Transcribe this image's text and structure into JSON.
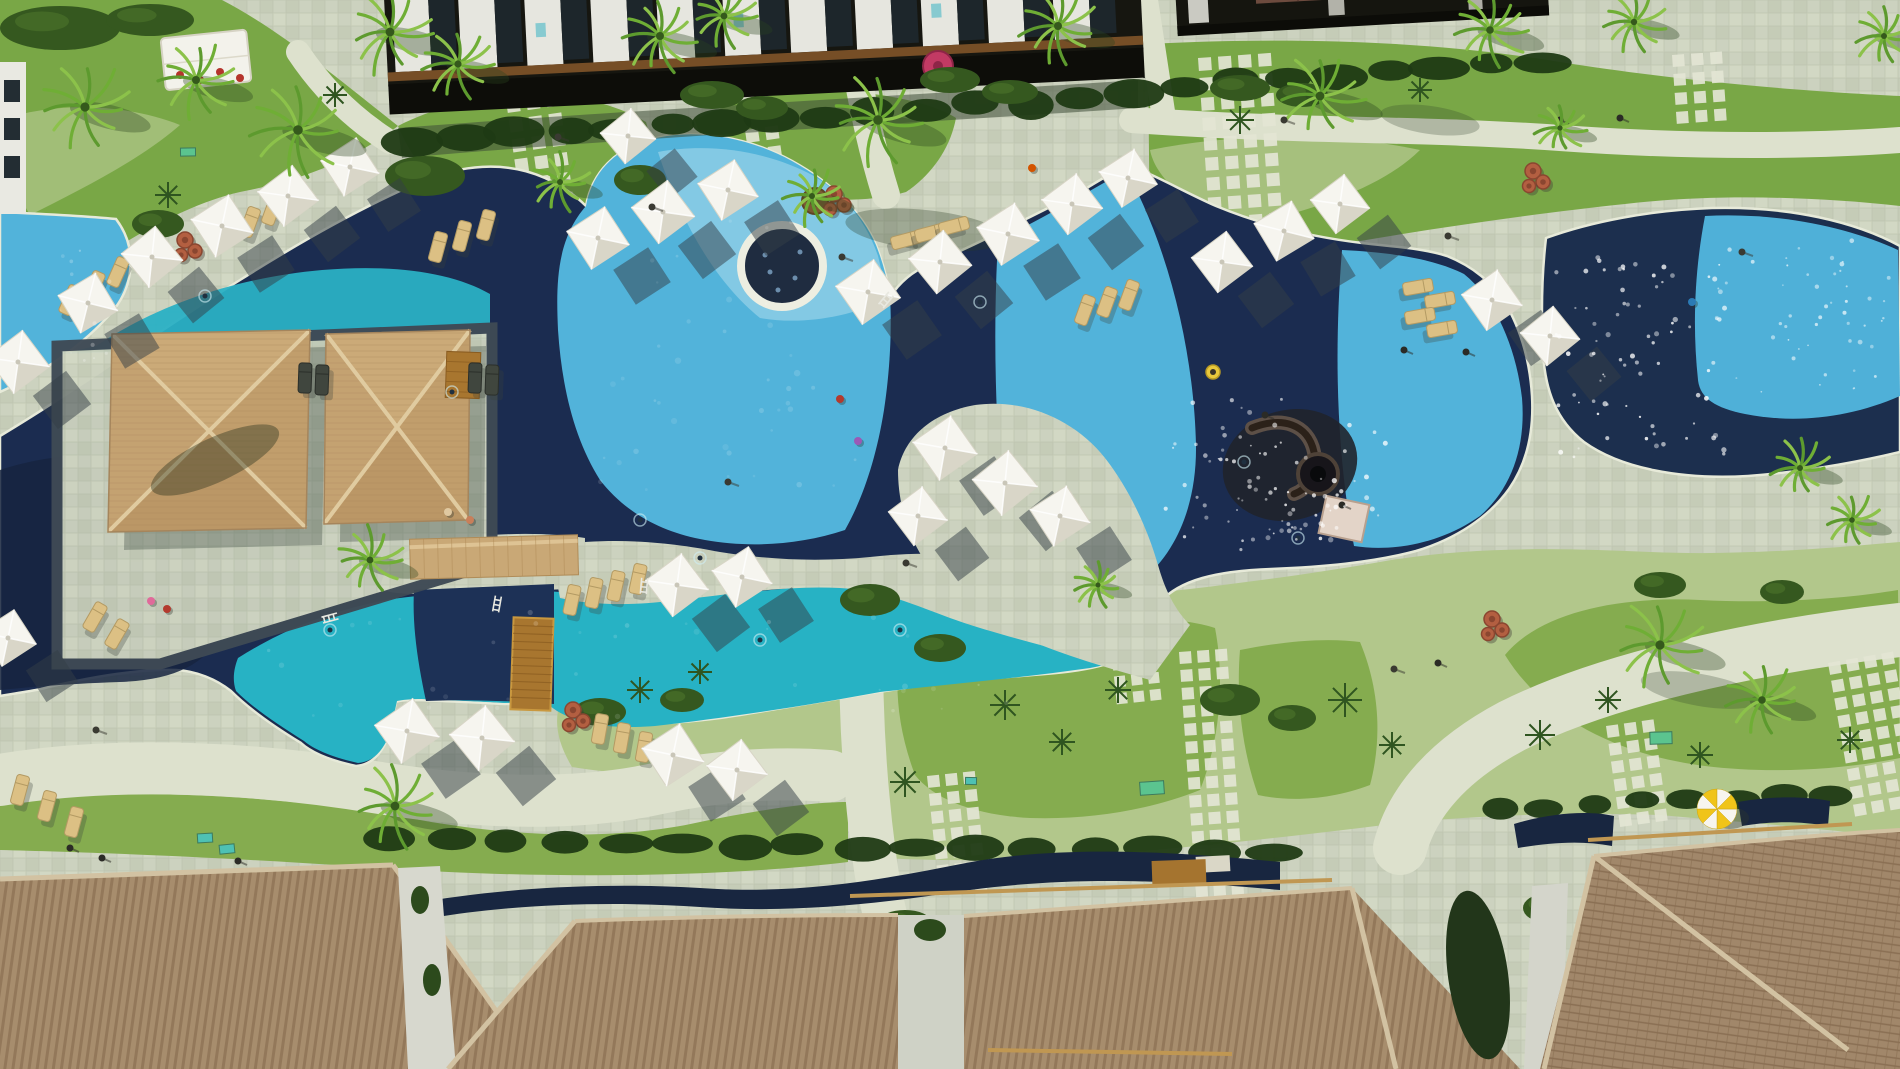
{
  "meta": {
    "description": "Aerial drone view of a tropical resort: lagoon swimming pools with alternating turquoise and navy sections, round spa, thatched cabanas, white sun umbrellas, gardens and tiled villa roofs",
    "view": "top-down aerial photo",
    "width": 1900,
    "height": 1069
  },
  "palette": {
    "deck": "#ccd2bf",
    "deck_alt": "#c2c9b3",
    "deck_bright": "#dde1cd",
    "pool_dark": "#1b2c50",
    "pool_darker": "#16253f",
    "pool_light": "#52b3da",
    "pool_pale": "#83c9e4",
    "pool_teal": "#27b2c4",
    "pool_band_dark": "#1d3156",
    "grass": "#79a746",
    "grass_bright": "#85ac4f",
    "groundcover": "#b2c78b",
    "hedge": "#1f3a14",
    "bush": "#35581f",
    "cabana_tan": "#c7a472",
    "ridge": "#e0cba0",
    "roof_brown": "#a78d6d",
    "roof_stripe": "#8f7456",
    "roof_cap": "#d2c2a2",
    "wood": "#a8762f",
    "terracotta": "#b35f41",
    "umbrella": "#f6f5ef",
    "umbrella_shade": "#d9d6c8",
    "shadow": "#333d46",
    "palm": "#6fae35",
    "sparkle": "#ffffff",
    "building_dark": "#161610",
    "building_wall": "#e6e6df",
    "balcony_wood": "#7b5128"
  },
  "objects": {
    "umbrellas": [
      [
        18,
        362,
        64,
        8
      ],
      [
        88,
        303,
        62,
        14
      ],
      [
        152,
        257,
        62,
        6
      ],
      [
        222,
        226,
        64,
        12
      ],
      [
        288,
        196,
        62,
        8
      ],
      [
        350,
        167,
        60,
        12
      ],
      [
        598,
        238,
        64,
        12
      ],
      [
        663,
        212,
        64,
        8
      ],
      [
        728,
        190,
        62,
        12
      ],
      [
        628,
        136,
        56,
        6
      ],
      [
        868,
        292,
        66,
        10
      ],
      [
        940,
        262,
        64,
        6
      ],
      [
        1008,
        234,
        64,
        12
      ],
      [
        1072,
        204,
        62,
        8
      ],
      [
        1128,
        178,
        60,
        12
      ],
      [
        1222,
        262,
        62,
        8
      ],
      [
        1284,
        231,
        62,
        14
      ],
      [
        1340,
        204,
        60,
        8
      ],
      [
        1492,
        300,
        62,
        10
      ],
      [
        1550,
        336,
        60,
        6
      ],
      [
        945,
        448,
        66,
        10
      ],
      [
        1005,
        483,
        66,
        6
      ],
      [
        1060,
        516,
        62,
        12
      ],
      [
        918,
        516,
        60,
        8
      ],
      [
        677,
        585,
        64,
        8
      ],
      [
        742,
        577,
        62,
        12
      ],
      [
        407,
        731,
        66,
        10
      ],
      [
        482,
        738,
        66,
        6
      ],
      [
        673,
        755,
        64,
        12
      ],
      [
        737,
        770,
        62,
        8
      ],
      [
        8,
        638,
        58,
        12
      ]
    ],
    "umbrella_shadow_offset": {
      "dx": 44,
      "dy": 38
    },
    "loungers": [
      [
        70,
        300,
        24,
        0
      ],
      [
        94,
        286,
        24,
        0
      ],
      [
        118,
        272,
        24,
        0
      ],
      [
        250,
        222,
        20,
        0
      ],
      [
        272,
        210,
        20,
        0
      ],
      [
        438,
        247,
        15,
        0
      ],
      [
        462,
        236,
        15,
        0
      ],
      [
        486,
        225,
        15,
        0
      ],
      [
        906,
        240,
        75,
        0
      ],
      [
        930,
        233,
        75,
        0
      ],
      [
        954,
        226,
        75,
        0
      ],
      [
        1085,
        310,
        20,
        0
      ],
      [
        1107,
        302,
        20,
        0
      ],
      [
        1129,
        295,
        20,
        0
      ],
      [
        1418,
        287,
        80,
        0
      ],
      [
        1440,
        300,
        80,
        0
      ],
      [
        1420,
        316,
        80,
        0
      ],
      [
        1442,
        329,
        80,
        0
      ],
      [
        95,
        617,
        30,
        0
      ],
      [
        117,
        634,
        30,
        0
      ],
      [
        20,
        790,
        15,
        0
      ],
      [
        47,
        806,
        15,
        0
      ],
      [
        74,
        822,
        15,
        0
      ],
      [
        600,
        729,
        10,
        0
      ],
      [
        622,
        738,
        10,
        0
      ],
      [
        644,
        747,
        10,
        0
      ],
      [
        572,
        600,
        12,
        0
      ],
      [
        594,
        593,
        12,
        0
      ],
      [
        616,
        586,
        12,
        0
      ],
      [
        638,
        579,
        12,
        0
      ],
      [
        305,
        378,
        2,
        1
      ],
      [
        322,
        380,
        2,
        1
      ],
      [
        475,
        378,
        2,
        1
      ],
      [
        492,
        380,
        2,
        1
      ]
    ],
    "palms": [
      [
        85,
        107,
        46
      ],
      [
        196,
        80,
        40
      ],
      [
        298,
        130,
        48
      ],
      [
        390,
        32,
        44
      ],
      [
        458,
        64,
        36
      ],
      [
        560,
        182,
        30
      ],
      [
        660,
        36,
        40
      ],
      [
        724,
        16,
        34
      ],
      [
        812,
        196,
        30
      ],
      [
        878,
        120,
        48
      ],
      [
        1058,
        26,
        40
      ],
      [
        1320,
        96,
        44
      ],
      [
        1490,
        30,
        38
      ],
      [
        1634,
        22,
        32
      ],
      [
        1884,
        36,
        30
      ],
      [
        370,
        560,
        34
      ],
      [
        395,
        806,
        44
      ],
      [
        1660,
        645,
        46
      ],
      [
        1762,
        700,
        38
      ],
      [
        1800,
        468,
        30
      ],
      [
        1852,
        520,
        28
      ],
      [
        1098,
        585,
        24
      ],
      [
        1560,
        128,
        26
      ]
    ],
    "yuccas": [
      [
        1005,
        705,
        15
      ],
      [
        1062,
        742,
        13
      ],
      [
        1118,
        690,
        13
      ],
      [
        1345,
        700,
        17
      ],
      [
        1392,
        745,
        13
      ],
      [
        1540,
        735,
        15
      ],
      [
        1608,
        700,
        13
      ],
      [
        905,
        782,
        15
      ],
      [
        1700,
        755,
        13
      ],
      [
        1850,
        740,
        13
      ],
      [
        640,
        690,
        13
      ],
      [
        700,
        672,
        12
      ],
      [
        1240,
        120,
        14
      ],
      [
        1420,
        90,
        12
      ],
      [
        168,
        195,
        13
      ],
      [
        335,
        95,
        12
      ]
    ],
    "bushes": [
      [
        425,
        176,
        40,
        20
      ],
      [
        158,
        224,
        26,
        14
      ],
      [
        640,
        180,
        26,
        15
      ],
      [
        712,
        95,
        32,
        14
      ],
      [
        762,
        108,
        26,
        12
      ],
      [
        950,
        80,
        30,
        13
      ],
      [
        1010,
        92,
        28,
        12
      ],
      [
        1240,
        88,
        30,
        13
      ],
      [
        1302,
        95,
        26,
        12
      ],
      [
        870,
        600,
        30,
        16
      ],
      [
        940,
        648,
        26,
        14
      ],
      [
        1230,
        700,
        30,
        16
      ],
      [
        1292,
        718,
        24,
        13
      ],
      [
        600,
        712,
        26,
        14
      ],
      [
        682,
        700,
        22,
        12
      ],
      [
        1660,
        585,
        26,
        13
      ],
      [
        1782,
        592,
        22,
        12
      ],
      [
        905,
        922,
        26,
        12
      ],
      [
        1545,
        908,
        22,
        14
      ],
      [
        60,
        28,
        60,
        22
      ],
      [
        150,
        20,
        44,
        16
      ]
    ],
    "hedgerows": [
      [
        415,
        140,
        1130,
        96,
        15,
        26,
        13
      ],
      [
        1185,
        86,
        1540,
        60,
        8,
        26,
        12
      ],
      [
        390,
        840,
        1270,
        852,
        16,
        26,
        11
      ],
      [
        1500,
        808,
        1830,
        795,
        8,
        20,
        10
      ]
    ],
    "stepping_grids": [
      [
        506,
        100,
        3,
        7,
        13,
        7,
        -8
      ],
      [
        745,
        130,
        2,
        5,
        13,
        7,
        -8
      ],
      [
        1198,
        58,
        4,
        9,
        13,
        7,
        -4
      ],
      [
        100,
        430,
        3,
        7,
        12,
        7,
        18
      ],
      [
        1672,
        55,
        3,
        4,
        12,
        7,
        -4
      ],
      [
        927,
        776,
        3,
        7,
        12,
        6,
        -6
      ],
      [
        1179,
        652,
        3,
        14,
        12,
        6,
        -4
      ],
      [
        1606,
        726,
        3,
        6,
        12,
        6,
        -8
      ],
      [
        1828,
        663,
        4,
        9,
        12,
        6,
        -10
      ],
      [
        975,
        542,
        3,
        8,
        11,
        6,
        -4
      ],
      [
        1105,
        592,
        3,
        7,
        11,
        6,
        -6
      ]
    ],
    "jar_clusters": [
      [
        185,
        249
      ],
      [
        834,
        203
      ],
      [
        573,
        719
      ],
      [
        1533,
        180
      ],
      [
        1492,
        628
      ]
    ],
    "sparkle_regions": [
      [
        1555,
        245,
        170,
        215,
        80,
        1.8,
        0.85
      ],
      [
        1705,
        230,
        185,
        165,
        50,
        1.6,
        0.7
      ],
      [
        1160,
        390,
        240,
        150,
        60,
        1.7,
        0.75
      ],
      [
        1240,
        480,
        130,
        70,
        30,
        1.8,
        0.8
      ],
      [
        590,
        210,
        270,
        280,
        40,
        2.2,
        0.16
      ],
      [
        260,
        610,
        760,
        110,
        35,
        2.0,
        0.18
      ],
      [
        55,
        245,
        55,
        120,
        12,
        1.5,
        0.3
      ]
    ],
    "mats": [
      [
        205,
        838,
        15,
        9,
        "#4ec1b4"
      ],
      [
        227,
        849,
        15,
        9,
        "#4ec1b4"
      ],
      [
        971,
        781,
        11,
        7,
        "#4ec1b4"
      ],
      [
        1152,
        788,
        24,
        13,
        "#5bc48f"
      ],
      [
        1661,
        738,
        22,
        12,
        "#5bc48f"
      ],
      [
        382,
        540,
        18,
        9,
        "#5bc48f"
      ],
      [
        188,
        152,
        15,
        8,
        "#5bc48f"
      ]
    ],
    "lamps": [
      [
        558,
        137
      ],
      [
        652,
        207
      ],
      [
        842,
        257
      ],
      [
        906,
        563
      ],
      [
        1394,
        669
      ],
      [
        1448,
        236
      ],
      [
        1284,
        120
      ],
      [
        96,
        730
      ],
      [
        1742,
        252
      ],
      [
        728,
        482
      ]
    ],
    "people": [
      [
        840,
        399,
        "#b33a2e"
      ],
      [
        858,
        441,
        "#9b59b6"
      ],
      [
        151,
        601,
        "#e06a9a"
      ],
      [
        167,
        609,
        "#b33a2e"
      ],
      [
        1032,
        168,
        "#d35400"
      ],
      [
        1692,
        302,
        "#2b7bb5"
      ],
      [
        448,
        512,
        "#e0c8a0"
      ],
      [
        470,
        520,
        "#c87f5a"
      ]
    ],
    "dark_figures": [
      [
        70,
        848
      ],
      [
        102,
        858
      ],
      [
        238,
        861
      ],
      [
        1438,
        663
      ],
      [
        1560,
        120
      ],
      [
        1620,
        118
      ],
      [
        1404,
        350
      ],
      [
        1466,
        352
      ],
      [
        1265,
        415
      ],
      [
        1342,
        505
      ]
    ],
    "swim_ripples": [
      [
        205,
        296
      ],
      [
        452,
        392
      ],
      [
        700,
        558
      ],
      [
        980,
        302
      ],
      [
        1244,
        462
      ],
      [
        1298,
        538
      ],
      [
        640,
        520
      ],
      [
        330,
        630
      ],
      [
        760,
        640
      ],
      [
        900,
        630
      ]
    ],
    "ladders": [
      [
        330,
        618,
        75
      ],
      [
        497,
        604,
        10
      ],
      [
        886,
        300,
        40
      ],
      [
        644,
        586,
        5
      ]
    ],
    "tent_chairs": [
      [
        180,
        75
      ],
      [
        200,
        80
      ],
      [
        220,
        72
      ],
      [
        240,
        78
      ]
    ],
    "spa_speckles": [
      [
        765,
        255
      ],
      [
        795,
        278
      ],
      [
        778,
        290
      ],
      [
        800,
        252
      ],
      [
        770,
        272
      ]
    ],
    "float_ring": {
      "x": 1213,
      "y": 372,
      "r": 7,
      "color": "#e8c83c"
    },
    "round_umbrella_pink": {
      "x": 938,
      "y": 66,
      "r": 15,
      "color": "#c23a64"
    },
    "round_umbrella_yellow": {
      "x": 1717,
      "y": 809,
      "r": 20,
      "color1": "#f0c419",
      "color2": "#f7f5ee"
    },
    "building_panels": 11,
    "counts": {
      "cabana_roofs": 2,
      "bridges": 1,
      "spas": 1,
      "water_play_structures": 1
    }
  }
}
